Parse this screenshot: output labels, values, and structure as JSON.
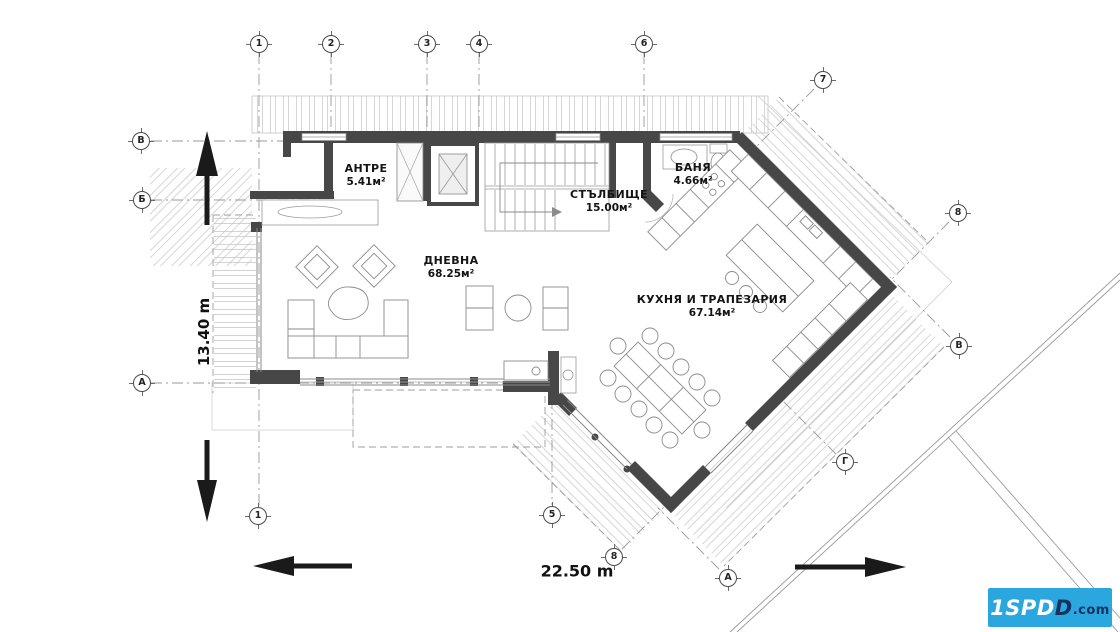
{
  "plan": {
    "title": "floor-plan",
    "dimensions": {
      "vertical": "13.40 m",
      "horizontal": "22.50 m"
    },
    "rooms": [
      {
        "id": "antre",
        "name": "АНТРЕ",
        "area": "5.41м²",
        "x": 366,
        "y": 176
      },
      {
        "id": "stalbishte",
        "name": "СТЪЛБИЩЕ",
        "area": "15.00м²",
        "x": 609,
        "y": 202
      },
      {
        "id": "banya",
        "name": "БАНЯ",
        "area": "4.66м²",
        "x": 693,
        "y": 175
      },
      {
        "id": "dnevna",
        "name": "ДНЕВНА",
        "area": "68.25м²",
        "x": 451,
        "y": 268
      },
      {
        "id": "kuhnya",
        "name": "КУХНЯ И ТРАПЕЗАРИЯ",
        "area": "67.14м²",
        "x": 712,
        "y": 307
      }
    ],
    "grid_markers": [
      {
        "label": "1",
        "x": 259,
        "y": 44
      },
      {
        "label": "2",
        "x": 331,
        "y": 44
      },
      {
        "label": "3",
        "x": 427,
        "y": 44
      },
      {
        "label": "4",
        "x": 479,
        "y": 44
      },
      {
        "label": "6",
        "x": 644,
        "y": 44
      },
      {
        "label": "7",
        "x": 823,
        "y": 80
      },
      {
        "label": "8",
        "x": 958,
        "y": 213
      },
      {
        "label": "В",
        "x": 959,
        "y": 346
      },
      {
        "label": "В",
        "x": 141,
        "y": 141
      },
      {
        "label": "Б",
        "x": 142,
        "y": 200
      },
      {
        "label": "А",
        "x": 142,
        "y": 383
      },
      {
        "label": "1",
        "x": 258,
        "y": 516
      },
      {
        "label": "5",
        "x": 552,
        "y": 515
      },
      {
        "label": "8",
        "x": 614,
        "y": 557
      },
      {
        "label": "А",
        "x": 728,
        "y": 578
      },
      {
        "label": "Г",
        "x": 845,
        "y": 462
      }
    ]
  },
  "logo": {
    "white_part": "1SPD",
    "dark_part": "D",
    "suffix": ".com",
    "bg": "#2BA7E0",
    "dark_color": "#16325F"
  }
}
